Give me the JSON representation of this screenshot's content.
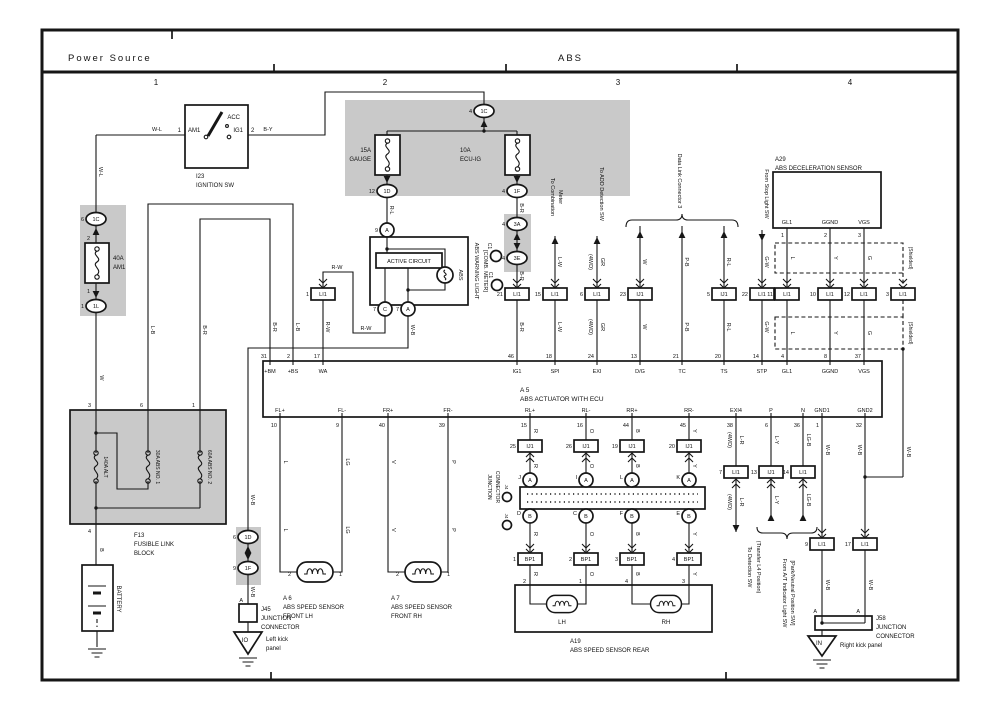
{
  "header": {
    "left": "Power Source",
    "center": "ABS",
    "cols": [
      "1",
      "2",
      "3",
      "4"
    ]
  },
  "wires": {
    "wl": "W-L",
    "by": "B-Y",
    "w": "W",
    "b": "B",
    "lb": "L-B",
    "br": "B-R",
    "rl": "R-L",
    "rw": "R-W",
    "wb": "W-B",
    "lw": "L-W",
    "gr": "GR",
    "pb": "P-B",
    "gw": "G-W",
    "l": "L",
    "y": "Y",
    "g": "G",
    "lg": "LG",
    "v": "V",
    "p": "P",
    "r": "R",
    "o": "O",
    "lr": "L-R",
    "ly": "L-Y",
    "lgb": "LG-B",
    "fourwd": "(4WD)"
  },
  "ignition": {
    "id": "I23",
    "name": "IGNITION SW",
    "acc": "ACC",
    "am1": "AM1",
    "ig1": "IG1",
    "pin_am1": "1",
    "pin_ig1": "2"
  },
  "power": {
    "fuse_am1_rating": "40A",
    "fuse_am1_name": "AM1",
    "fuse_gauge_rating": "15A",
    "fuse_gauge_name": "GAUGE",
    "fuse_ecuig_rating": "10A",
    "fuse_ecuig_name": "ECU-IG"
  },
  "connectors": {
    "c1c_left": {
      "pin": "6",
      "id": "1C"
    },
    "c1l": {
      "pin": "1",
      "id": "1L"
    },
    "c1c_top": {
      "pin": "4",
      "id": "1C"
    },
    "c1d": {
      "pin": "12",
      "id": "1D"
    },
    "c1f": {
      "pin": "4",
      "id": "1F"
    },
    "c3a": {
      "pin": "4",
      "id": "3A"
    },
    "c3e": {
      "pin": "4",
      "id": "3E"
    },
    "c1d2": {
      "pin": "6",
      "id": "1D"
    },
    "c1f2": {
      "pin": "9",
      "id": "1F"
    },
    "meter_a": {
      "pin": "9",
      "id": "A"
    },
    "meter_c_bot": {
      "pin": "7",
      "id": "C"
    },
    "meter_a_bot": {
      "pin": "7",
      "id": "A"
    },
    "am1_top": "2",
    "am1_bot": "1"
  },
  "f13": {
    "id": "F13",
    "name1": "FUSIBLE LINK",
    "name2": "BLOCK",
    "pin3": "3",
    "pin6": "6",
    "pin1": "1",
    "pin4": "4",
    "fuse_alt": "140A ALT",
    "fuse_abs1": "30A ABS NO. 1",
    "fuse_abs2": "60A ABS NO. 2"
  },
  "battery": {
    "name": "BATTERY"
  },
  "meter": {
    "active": "ACTIVE CIRCUIT",
    "bulb": "ABS",
    "label1": "ABS WARNING LIGHT",
    "label2": "[COMB. METER]",
    "c1": "C1"
  },
  "jb": {
    "wa": {
      "pin": "1",
      "id": "LI1"
    },
    "ig1": {
      "pin": "21",
      "id": "LI1"
    },
    "spi": {
      "pin": "15",
      "id": "LI1"
    },
    "exi": {
      "pin": "6",
      "id": "LI1"
    },
    "dg": {
      "pin": "23",
      "id": "IJ1"
    },
    "ts": {
      "pin": "5",
      "id": "IJ1"
    },
    "stp": {
      "pin": "22",
      "id": "LI1"
    },
    "gl1": {
      "pin": "11",
      "id": "LI1"
    },
    "ggnd": {
      "pin": "10",
      "id": "LI1"
    },
    "vgs": {
      "pin": "12",
      "id": "LI1"
    },
    "shield": {
      "pin": "3",
      "id": "LI1"
    },
    "rlp": {
      "pin": "25",
      "id": "IJ1"
    },
    "rlm": {
      "pin": "26",
      "id": "IJ1"
    },
    "rrp": {
      "pin": "19",
      "id": "IJ1"
    },
    "rrm": {
      "pin": "20",
      "id": "IJ1"
    },
    "exi4": {
      "pin": "7",
      "id": "LI1"
    },
    "p": {
      "pin": "13",
      "id": "IJ1"
    },
    "n": {
      "pin": "14",
      "id": "LI1"
    },
    "gnd1": {
      "pin": "9",
      "id": "LI1"
    },
    "gnd2": {
      "pin": "17",
      "id": "LI1"
    },
    "bp1": {
      "pin": "1",
      "id": "BP1"
    },
    "bp2": {
      "pin": "2",
      "id": "BP1"
    },
    "bp3": {
      "pin": "3",
      "id": "BP1"
    },
    "bp4": {
      "pin": "4",
      "id": "BP1"
    }
  },
  "actuator": {
    "id": "A 5",
    "name": "ABS ACTUATOR WITH ECU",
    "top": [
      {
        "n": "31",
        "t": "+BM"
      },
      {
        "n": "2",
        "t": "+BS"
      },
      {
        "n": "17",
        "t": "WA"
      },
      {
        "n": "46",
        "t": "IG1"
      },
      {
        "n": "18",
        "t": "SPI"
      },
      {
        "n": "24",
        "t": "EXI"
      },
      {
        "n": "13",
        "t": "D/G"
      },
      {
        "n": "21",
        "t": "TC"
      },
      {
        "n": "20",
        "t": "TS"
      },
      {
        "n": "14",
        "t": "STP"
      },
      {
        "n": "4",
        "t": "GL1"
      },
      {
        "n": "8",
        "t": "GGND"
      },
      {
        "n": "37",
        "t": "VGS"
      }
    ],
    "bottom": [
      {
        "t": "FL+",
        "n": "10"
      },
      {
        "t": "FL-",
        "n": "9"
      },
      {
        "t": "FR+",
        "n": "40"
      },
      {
        "t": "FR-",
        "n": "39"
      },
      {
        "t": "RL+",
        "n": "15"
      },
      {
        "t": "RL-",
        "n": "16"
      },
      {
        "t": "RR+",
        "n": "44"
      },
      {
        "t": "RR-",
        "n": "45"
      },
      {
        "t": "EXI4",
        "n": "38"
      },
      {
        "t": "P",
        "n": "6"
      },
      {
        "t": "N",
        "n": "36"
      },
      {
        "t": "GND1",
        "n": "1"
      },
      {
        "t": "GND2",
        "n": "32"
      }
    ]
  },
  "decel": {
    "id": "A29",
    "name": "ABS DECELERATION SENSOR",
    "pins": [
      "GL1",
      "GGND",
      "VGS"
    ],
    "nums": [
      "1",
      "2",
      "3"
    ],
    "nums2": [
      "4",
      "8",
      "37"
    ],
    "shielded": "(Shielded)"
  },
  "sensors": {
    "a6": {
      "id": "A 6",
      "name1": "ABS SPEED SENSOR",
      "name2": "FRONT LH",
      "p2": "2",
      "p1": "1"
    },
    "a7": {
      "id": "A 7",
      "name1": "ABS SPEED SENSOR",
      "name2": "FRONT RH",
      "p2": "2",
      "p1": "1"
    },
    "a19": {
      "id": "A19",
      "name": "ABS SPEED SENSOR REAR",
      "lh": "LH",
      "rh": "RH",
      "pins": [
        "2",
        "1",
        "4",
        "3"
      ]
    }
  },
  "rear_jc": {
    "label1": "JUNCTION",
    "label2": "CONNECTOR",
    "j4": "J4",
    "top_letters": [
      "J",
      "I",
      "L",
      "K"
    ],
    "bot_letters": [
      "D",
      "C",
      "F",
      "E"
    ],
    "a": "A",
    "b": "B"
  },
  "dest": {
    "comb1": "To Combination",
    "comb2": "Meter",
    "add": "To ADD Detection SW",
    "dlc": "Data Link Connector 3",
    "stop": "From Stop Light SW",
    "det1": "To Detection SW",
    "det2": "(Transfer L4 Position)",
    "at1": "From A/T Indicator Light SW",
    "at2": "[Park/Neutral Position SW]"
  },
  "grounds": {
    "j45": {
      "id": "J45",
      "l1": "JUNCTION",
      "l2": "CONNECTOR",
      "code": "IO",
      "loc1": "Left kick",
      "loc2": "panel",
      "a": "A"
    },
    "j58": {
      "id": "J58",
      "l1": "JUNCTION",
      "l2": "CONNECTOR",
      "code": "IN",
      "loc": "Right kick panel",
      "a": "A"
    }
  }
}
